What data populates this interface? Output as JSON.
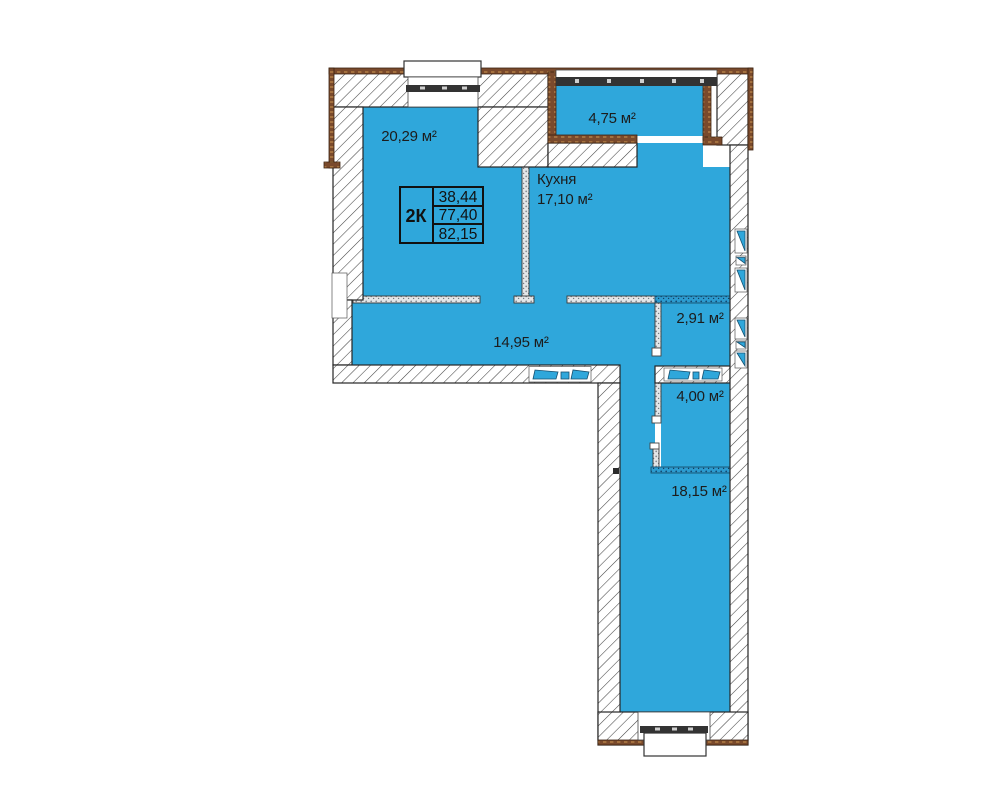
{
  "plan": {
    "unit_type_label": "2К",
    "area_table": {
      "row1": "38,44",
      "row2": "77,40",
      "row3": "82,15"
    },
    "rooms": {
      "living": {
        "area": "20,29 м²"
      },
      "balcony": {
        "area": "4,75 м²"
      },
      "kitchen": {
        "name": "Кухня",
        "area": "17,10 м²"
      },
      "wc": {
        "area": "2,91 м²"
      },
      "hall": {
        "area": "14,95 м²"
      },
      "bathroom": {
        "area": "4,00 м²"
      },
      "bedroom": {
        "area": "18,15 м²"
      }
    },
    "colors": {
      "floor": "#2fa7db",
      "wall_hatch_line": "#454545",
      "insulation": "#7a4a2c",
      "glazing_frame": "#333333",
      "label_text": "#1c1c1c"
    }
  }
}
